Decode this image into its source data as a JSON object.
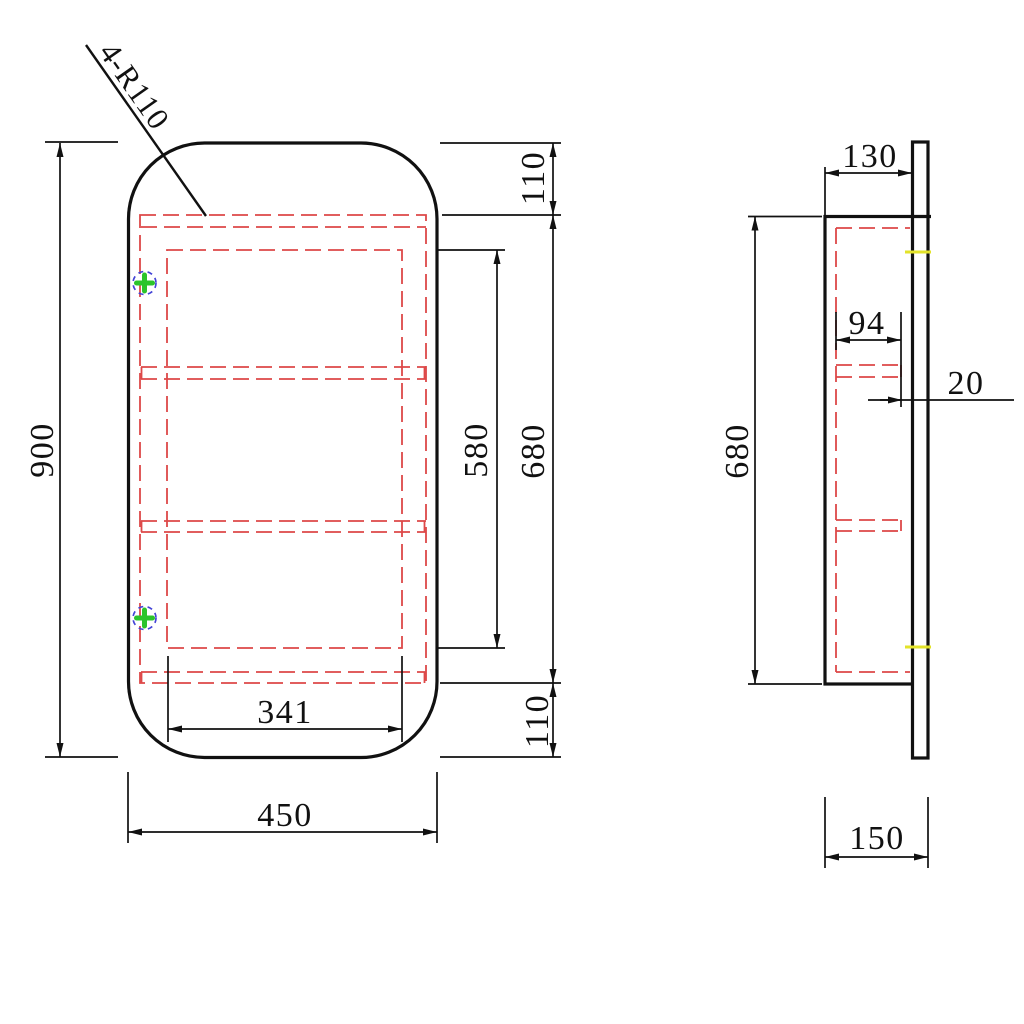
{
  "front_view": {
    "radius_label": "4-R110",
    "overall_height": "900",
    "overall_width": "450",
    "top_inset": "110",
    "bottom_inset": "110",
    "interior_height": "680",
    "opening_height": "580",
    "opening_width": "341"
  },
  "side_view": {
    "body_depth": "130",
    "shelf_depth": "94",
    "front_gap": "20",
    "interior_height": "680",
    "overall_depth": "150"
  },
  "colors": {
    "outline": "#111111",
    "hidden_line_red": "#dd4848",
    "hinge_cross_green": "#2bc42b",
    "hinge_circle_blue": "#4343d6",
    "highlight_yellow": "#e3e32a",
    "background": "#ffffff"
  }
}
